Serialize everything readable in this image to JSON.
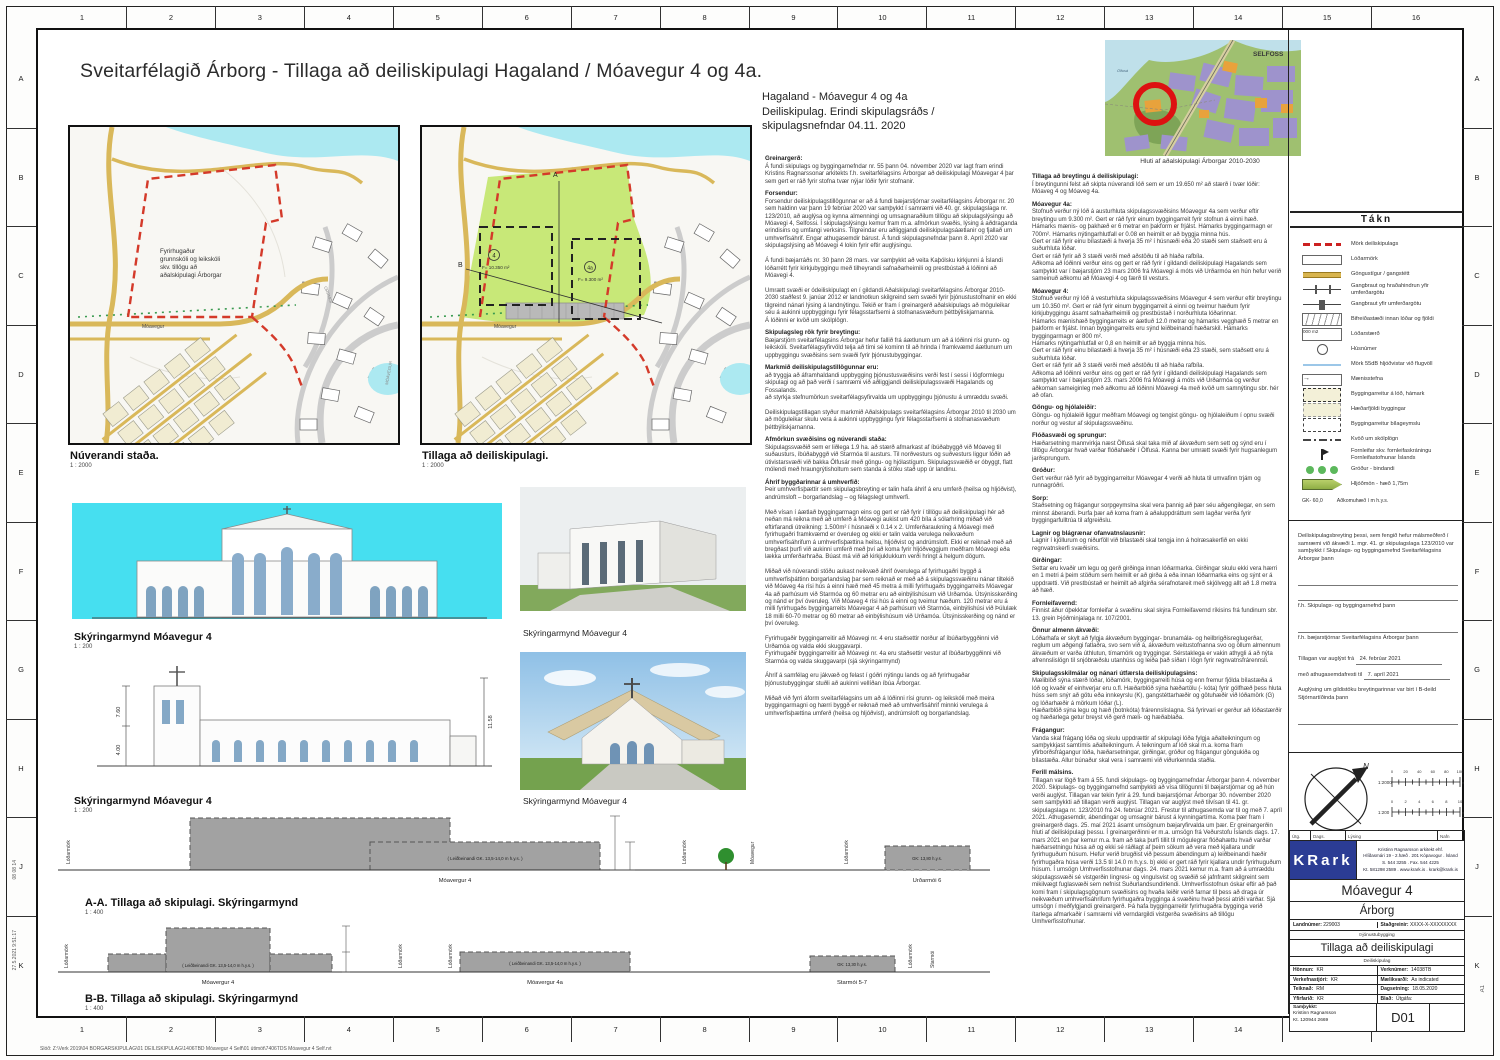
{
  "title": "Sveitarfélagið Árborg - Tillaga að deiliskipulagi Hagaland / Móavegur 4 og 4a.",
  "header_note": "Hagaland -  Móavegur 4 og 4a\nDeiliskipulag. Erindi skipulagsráðs /\nskipulagsnefndar 04.11. 2020",
  "frame": {
    "cols": [
      "1",
      "2",
      "3",
      "4",
      "5",
      "6",
      "7",
      "8",
      "9",
      "10",
      "11",
      "12",
      "13",
      "14",
      "15",
      "16"
    ],
    "rows": [
      "A",
      "B",
      "C",
      "D",
      "E",
      "F",
      "G",
      "H",
      "J",
      "K"
    ]
  },
  "maps": {
    "left": {
      "label": "Núverandi staða.",
      "scale": "1 : 2000",
      "school_lines": [
        "Fyrirhugaður",
        "grunnskóli og leikskóli",
        "skv. tillögu að",
        "aðalskipulagi Árborgar"
      ],
      "street": "Móavegur"
    },
    "right": {
      "label": "Tillaga að deiliskipulagi.",
      "scale": "1 : 2000",
      "p4": {
        "num": "4",
        "area": "F= 10.350 m²"
      },
      "p4a": {
        "num": "4a",
        "area": "F= 9.300 m²"
      },
      "markA": "A",
      "markB": "B",
      "street": "Móavegur"
    },
    "street_orrmoi": "ORRMÓI",
    "street_moavegur": "MÓAVEGUR"
  },
  "overview": {
    "caption": "Hluti af aðalskipulagi Árborgar 2010-2030",
    "city": "SELFOSS",
    "river": "Ölfusá"
  },
  "elev1": {
    "caption": "Skýringarmynd Móavegur 4",
    "scale": "1 : 200"
  },
  "elev2": {
    "caption": "Skýringarmynd Móavegur 4",
    "scale": "1 : 200",
    "dims": [
      "7.60",
      "4.00",
      "11.58"
    ]
  },
  "render1": {
    "caption": "Skýringarmynd Móavegur 4"
  },
  "render2": {
    "caption": "Skýringarmynd Móavegur 4"
  },
  "sec": {
    "lod": "Lóðarmörk",
    "gk_note": "( Leiðbeinandi GK. 13,5-14,0 m h.y.s. )",
    "a": {
      "title": "A-A. Tillaga að skipulagi. Skýringarmynd",
      "scale": "1 : 400",
      "b1": "Móavergur 4",
      "b2": "Urðarmói 6",
      "gk2": "GK: 13,80 h.y.s.",
      "street": "Móavegur"
    },
    "b": {
      "title": "B-B. Tillaga að skipulagi. Skýringarmynd",
      "scale": "1 : 400",
      "b1": "Móavergur 4",
      "b2": "Móavergur 4a",
      "b3": "Starmói 5-7",
      "gk3": "GK: 13,30 h.y.s.",
      "street": "Starmói"
    }
  },
  "col1": {
    "sections": [
      {
        "h": "Greinargerð:",
        "p": "Á fundi skipulags og byggingarnefndar nr. 55 þann 04. nóvember 2020 var lagt fram erindi Kristins Ragnarssonar arkitekts f.h. sveitarfélagsins Árborgar að deiliskipulagi Móavegar 4 þar sem gert er ráð fyrir stofna tvær nýjar lóðir fyrir stofnanir."
      },
      {
        "h": "Forsendur:",
        "p": "Forsendur deiliskipulagstillögunnar er að á fundi bæjarstjórnar sveitarfélagsins Árborgar nr. 20 sem haldinn var þann 19 febrúar 2020 var samþykkt í samræmi við 40. gr. skipulagslaga nr. 123/2010, að auglýsa og kynna almenningi og umsagnaraðilum tillögu að skipulagslýsingu að Móavegi 4, Selfossi. Í skipulagslýsingu kemur fram m.a. afmörkun svæðis, lýsing á aðdraganda erindisins og umfangi verksins. Tilgreindar eru aðliggjandi deiliskipulagsáætlanir og fjallað um umhverfisáhrif. Engar athugasemdir bárust. Á fundi skipulagsnefndar þann 8. Apríl 2020 var skipulagslýsing að Móavegi 4 lokin fyrir eftir auglýsingu.\n\nÁ fundi bæjarráðs nr. 30 þann 28 mars. var samþykkt að veita Kaþólsku kirkjunni á Íslandi lóðarrétt fyrir kirkjubyggingu með tilheyrandi safnaðarheimili og prestbústað á lóðinni að Móavegi 4.\n\nUmrætt svæði er ódeiliskipulagt en í gildandi Aðalskipulagi sveitarfélagsins Árborgar 2010-2030 staðfest 9. janúar 2012 er landnotkun skilgreind sem svæði fyrir þjónustustofnanir en ekki tilgreind nánari lýsing á landnýtingu. Tekið er fram í greinargerð aðalskipulags að möguleikar séu á aukinni uppbyggingu fyrir félagsstarfsemi á stofnanasvæðum þéttbýliskjarnanna.\nÁ lóðinni er kvöð um skólplögn."
      },
      {
        "h": "Skipulagsleg rök fyrir breytingu:",
        "p": "Bæjarstjórn sveitarfélagsins Árborgar hefur fallið frá áætlunum um að á lóðinni rísi grunn- og leikskóli. Sveitarfélagsyfirvöld telja að tími sé kominn til að hrinda í framkvæmd áætlunum um uppbyggingu svæðisins sem svæði fyrir þjónustubyggingar."
      },
      {
        "h": "Markmið deiliskipulagstillögunnar eru:",
        "p": "að tryggja að áframhaldandi uppbygging þjónustusvæðisins verði fest í sessi í lögformlegu skipulagi og að það verði í samræmi við aðliggjandi deiliskipulagssvæði Hagalands og Fossalands.\nað styrkja stefnumörkun sveitarfélagsyfirvalda um uppbyggingu þjónustu á umræddu svæði.\n\nDeiliskipulagstillagan styður markmið Aðalskipulags sveitarfélagsins Árborgar 2010 til 2030 um að möguleikar skulu vera á aukinni uppbyggingu fyrir félagsstarfsemi á stofnanasvæðum þéttbýliskjarnanna."
      },
      {
        "h": "Afmörkun svæðisins og núverandi staða:",
        "p": "Skipulagssvæðið sem er liðlega 1.9 ha. að stærð afmarkast af íbúðabyggð við Móaveg til suðausturs, íbúðabyggð við Starmóa til austurs. Til norðvesturs og suðvesturs liggur lóðin að útivistarsvæði við bakka Ölfusár með göngu- og hjólastígum. Skipulagssvæðið er óbyggt, flatt mólendi með hraungrýtisholtum sem standa á stöku stað upp úr landinu."
      },
      {
        "h": "Áhrif byggðarinnar á umhverfið:",
        "p": "Þeir umhverfisþættir sem skipulagsbreyting er talin hafa áhrif á eru umferð (heilsa og hljóðvist), andrúmsloft – borgarlandslag – og félagslegt umhverfi.\n\nMeð vísan í áætlað byggingarmagn eins og gert er ráð fyrir í tillögu að deiliskipulagi hér að neðan má reikna með að umferð á Móavegi aukist um 420 bíla á sólarhring miðað við eftirfarandi útreikning: 1.500m² í húsnæði x 0.14 x 2. Umferðaraukning á Móavegi með fyrirhugaðri framkvæmd er óveruleg og ekki er talin valda verulega neikvæðum umhverfisáhrifum á umhverfisþættina heilsu, hljóðvist og andrúmsloft. Ekki er reiknað með að bregðast þurfi við aukinni umferð með því að koma fyrir hljóðveggjum meðfram Móavegi eða lækka umferðarhraða. Búast má við að kirkjuklukkum verði hringt á helgum dögum.\n\nMiðað við núverandi stöðu aukast neikvæð áhrif óverulega af fyrirhugaðri byggð á umhverfisþáttinn borgarlandslag þar sem reiknað er með að á skipulagssvæðinu nánar tiltekið við Móaveg 4a rísi hús á einni hæð með 45 metra á milli fyrirhugaðs byggingarreits Móavegar 4a að parhúsum við Starmóa og 60 metrar eru að einbýlishúsum við Urðamóa. Útsýnisskerðing og nánd er því óveruleg. Við Móaveg 4 rísi hús á einni og tveimur hæðum. 120 metrar eru á milli fyrirhugaðs byggingarreits Móavegar 4 að parhúsum við Starmóa, einbýlishúsi við Þúlulæk 18 milli 60-70 metrar og 60 metrar að einbýlishúsum við Urðamóa. Útsýnisskerðing og nánd er því óveruleg.\n\nFyrirhugaðir byggingarreitir að Móavegi nr. 4 eru staðsettir norður af íbúðarbyggðinni við Urðamóa og valda ekki skuggavarpi.\nFyrirhugaðir byggingarreitir að Móavegi nr. 4a eru staðsettir vestur af íbúðarbyggðinni við Starmóa og valda skuggavarpi (sjá skýringarmynd)\n\nÁhrif á samfélag eru jákvæð og felast í góðri nýtingu lands og að fyrirhugaðar þjónustubyggingar stuðli að aukinni vellíðan íbúa Árborgar.\n\nMiðað við fyrri áform sveitarfélagsins um að á lóðinni rísi grunn- og leikskóli með meira byggingarmagni og hærri byggð er reiknað með að umhverfisáhrif minnki verulega á umhverfisþættina umferð (heilsa og hljóðvist), andrúmsloft og borgarlandslag."
      }
    ]
  },
  "col2": {
    "sections": [
      {
        "h": "Tillaga að breytingu á deiliskipulagi:",
        "p": "Í breytingunni felst að skipta núverandi lóð sem er um 19.650 m² að stærð í tvær lóðir: Móaveg 4 og Móaveg 4a."
      },
      {
        "h": "Móavegur 4a:",
        "p": "Stofnuð verður ný lóð á austurhluta skipulagssvæðisins Móavegur 4a sem verður eftir breytingu um 9.300 m². Gert er ráð fyrir einum byggingarreit fyrir stofnun á einni hæð. Hámarks mænis- og þakhæð er 6 metrar en þakform er frjálst. Hámarks byggingarmagn er 700m². Hámarks nýtingarhlutfall er 0.08 en heimilt er að byggja minna hús.\nGert er ráð fyrir einu bílastæði á hverja 35 m² í húsnæði eða 20 stæði sem staðsett eru á suðurhluta lóðar.\nGert er ráð fyrir að 3 stæði verði með aðstöðu til að hlaða rafbíla.\nAðkoma að lóðinni verður eins og gert er ráð fyrir í gildandi deiliskipulagi Hagalands sem samþykkt var í bæjarstjórn 23 mars 2006 frá Móavegi á móts við Urðarmóa en hún hefur verið sameinuð aðkomu að Móavegi 4 og færð til vesturs."
      },
      {
        "h": "Móavegur 4:",
        "p": "Stofnuð verður ný lóð á vesturhluta skipulagssvæðisins Móavegur 4 sem verður eftir breytingu um 10.350 m². Gert er ráð fyrir einum byggingarreit á einni og tveimur hæðum fyrir kirkjubyggingu ásamt safnaðarheimili og prestbústað í norðurhluta lóðarinnar.\nHámarks mænishæð byggingarreits er áætluð 12.0 metrar og hámarks vegghæð 5 metrar en þakform er frjálst. Innan byggingarreits eru sýnd leiðbeinandi hæðarskil.  Hámarks byggingarmagn er 800 m².\nHámarks nýtingarhlutfall er  0,8 en heimilt er að byggja minna hús.\nGert er ráð fyrir einu bílastæði á hverja 35 m² í húsnæði eða 23 stæði, sem staðsett eru á suðurhluta lóðar.\nGert er ráð fyrir að 3 stæði verði með aðstöðu til að hlaða rafbíla.\nAðkoma að lóðinni verður eins og gert er ráð fyrir í gildandi deiliskipulagi Hagalands sem samþykkt var í bæjarstjórn 23. mars 2006 frá Móavegi á móts við Urðarmóa og verður aðkoman sameiginleg með aðkomu að lóðinni  Móavegi 4a með kvöð  um samnýtingu sbr. hér að ofan."
      },
      {
        "h": "Göngu- og hjólaleiðir:",
        "p": "Göngu- og hjólaleið liggur meðfram Móavegi og tengist göngu- og hjólaleiðum í opnu svæði norður og vestur af skipulagssvæðinu."
      },
      {
        "h": "Flóðasvæði og sprungur:",
        "p": "Hæðarsetning mannvirkja næst Ölfusá skal taka mið af ákvæðum sem sett og sýnd eru í tillögu Árborgar hvað varðar flóðahæðir í Ölfusá. Kanna ber umrætt svæði fyrir hugsanlegum jarðsprungum."
      },
      {
        "h": "Gróður:",
        "p": "Gert verður ráð fyrir að byggingarreitur Móavegar 4 verði að hluta til umvafinn trjám og runnagróðri."
      },
      {
        "h": "Sorp:",
        "p": "Staðsetning og frágangur sorpgeymslna skal vera þannig að þær séu aðgengilegar, en sem minnst áberandi. Þurfa þær að koma fram á aðaluppdráttum sem lagðar verða fyrir byggingarfulltrúa til afgreiðslu."
      },
      {
        "h": "Lagnir og blágrænar ofanvatnslausnir:",
        "p": "Lagnir í kjöllurum og niðurföll við bílastæði skal tengja inn á holræsakerfið en ekki regnvatnskerfi svæðisins."
      },
      {
        "h": "Girðingar:",
        "p": "Settar eru kvaðir um legu og gerð girðinga  innan lóðarmarka. Girðingar skulu ekki vera hærri en 1 metri á þeim stöðum sem heimilt er að girða á eða innan lóðarmarka eins og sýnt er á uppdrætti. Við prestbústað er heimilt að afgirða sérafnotareit með skjólvegg allt að 1.8 metra að hæð."
      },
      {
        "h": "Fornleifavernd:",
        "p": "Finnist áður óþekktar fornleifar á svæðinu skal skýra Fornleifavernd ríkisins frá fundinum sbr. 13. grein Þjóðminjalaga nr. 107/2001."
      },
      {
        "h": "Önnur almenn ákvæði:",
        "p": "Lóðarhafa er skylt að fylgja ákvæðum byggingar- brunamála- og heilbrigðisreglugerðar, reglum um aðgengi fatlaðra, svo sem við á, ákvæðum veitustofnanna svo og öllum almennum ákvæðum er varða úthlutun, tímamörk og tryggingar. Sérstaklega er vakin athygli á að nýta afrennslislögn til snjóbræðslu utanhúss og leiða það síðan í lögn fyrir regnvatnsfrárennsli."
      },
      {
        "h": "Skipulagsskilmálar og nánari útfærsla deiliskipulagsins:",
        "p": "Mæliblöð sýna stærð lóðar, lóðamörk, byggingarreiti húsa og enn fremur fjölda bílastæða á lóð og kvaðir ef einhverjar eru o.fl. Hæðarblöð sýna hæðartölu (- kóta) fyrir gólfhæð þess hluta húss sem snýr að götu eða innkeyrslu (K), gangstéttarhæðir og götuhæðir við lóðamörk (G) og lóðarhæðir á mörkum lóðar (L).\nHæðarblöð sýna legu og hæð (botnkóta) frárennslislagna. Sá fyrirvari er gerður að lóðastærðir og hæðarlega getur breyst við gerð mæli- og hæðablaða."
      },
      {
        "h": "Frágangur:",
        "p": "Vanda skal frágang lóða og skulu uppdrættir af skipulagi lóða fylgja aðalteikningum og samþykkjast samtímis aðalteikningum. Á teikningum af lóð skal m.a. koma fram yfirborðsfrágangur lóða, hæðarsetningar, girðingar, gróður og frágangur göngukiða og bílastæða. Allur búnaður skal vera í samræmi við viðurkennda staðla."
      },
      {
        "h": "Ferill málsins.",
        "p": "Tillagan var lögð fram á 55. fundi skipulags- og byggingarnefndar Árborgar þann 4. nóvember 2020. Skipulags- og byggingarnefnd samþykkti að vísa tillögunni til bæjarstjórnar og að hún verði auglýst. Tillagan var tekin fyrir á 29. fundi bæjarstjórnar Árborgar 30. nóvember 2020 sem samþykkti að tillagan verði auglýst. Tillagan var auglýst með tilvísan til 41. gr. skipulagslaga nr. 123/2010 frá 24. febrúar 2021. Frestur til athugasemda var til og með 7. apríl 2021. Athugasemdir, ábendingar og umsagnir bárust á kynningartíma. Koma þær fram í greinargerð dags. 25. maí 2021 ásamt umsögnum bæjaryfirvalda um þær. Er greinargerðin hluti af deiliskipulagi þessu. Í greinargerðinni er m.a. umsögn frá Veðurstofu Íslands dags. 17. mars 2021 en þar kemur m.a. fram að taka þurfi tillit til mögulegrar flóðahættu hvað varðar hæðarsetningu húsa að og ekki sé ráðlagt af þeim sökum að vera með kjallara undir fyrirhuguðum húsum. Hefur verið brugðist við þessum ábendingum a) leiðbeinandi hæðir fyrirhugaðra húsa verði 13.5 til 14.0 m h.y.s. b) ekki er gert ráð fyrir kjallara undir fyrirhuguðum húsum. Í umsögn Umhverfisstofnunar dags. 24. mars 2021 kemur m.a. fram að á umræddu skipulagssvæði sé vistgerðin lingresi- og vingulsvist og svæðið sé jafnframt skilgreint sem mikilvægt fuglasvæði sem nefnist Suðurlandsundirlendi. Umhverfisstofnun óskar eftir að það komi fram í skipulagsgögnum svæðisins og hvaða leiðir verið farnar til þess að draga úr neikvæðum umhverfisáhrifum fyrirhugaðra bygginga á svæðinu hvað þessi atriði varðar. Sjá umsögn í meðfylgjandi greinargerð. Þá hafa byggingarreitir fyrirhugaðra bygginga verið ítarlega afmarkaðir í samræmi við verndargildi vistgerða svæðisins að tillögu Umhverfisstofnunar."
      }
    ]
  },
  "legend": {
    "title": "Tákn",
    "items": [
      {
        "c": "boundary",
        "sym": "",
        "label": "Mörk deiliskipulags"
      },
      {
        "c": "lotline",
        "sym": "",
        "label": "Lóðarmörk"
      },
      {
        "c": "path",
        "sym": "",
        "label": "Göngustígur / gangstétt"
      },
      {
        "c": "xbump",
        "sym": "",
        "label": "Gangbraut og hraðahindrun yfir umferðargötu"
      },
      {
        "c": "xwalk",
        "sym": "",
        "label": "Gangbraut yfir umferðargötu"
      },
      {
        "c": "parking",
        "sym": "",
        "label": "Bifreiðastæði innan lóðar og fjöldi"
      },
      {
        "c": "lotsize",
        "sym": "000 m2",
        "label": "Lóðarstærð"
      },
      {
        "c": "housenum",
        "sym": "",
        "label": "Húsnúmer"
      },
      {
        "c": "noise55",
        "sym": "",
        "label": "Mörk 55dB hljóðvistar við flugvöll"
      },
      {
        "c": "ridge",
        "sym": "→",
        "label": "Mænisstefna"
      },
      {
        "c": "bldgreit",
        "sym": "",
        "label": "Byggingarreitur á lóð, hámark"
      },
      {
        "c": "heightzone",
        "sym": "",
        "label": "Hæðarfjöldi byggingar"
      },
      {
        "c": "garagereit",
        "sym": "",
        "label": "Byggingarreitur bílageymslu"
      },
      {
        "c": "sewer",
        "sym": "",
        "label": "Kvöð um skólplögn"
      },
      {
        "c": "fornleifar",
        "sym": "",
        "label": "Fornleifar skv. fornleifaskráningu Fornleifastofnunar Íslands"
      },
      {
        "c": "grodur",
        "sym": "",
        "label": "Gróður - bindandi"
      },
      {
        "c": "hljodmon",
        "sym": "",
        "label": "Hljóðmön - hæð 1,75m"
      }
    ],
    "gk_sym": "GK- 60,0",
    "gk_label": "Aðkomuhæð í m h.y.s."
  },
  "approval": {
    "intro": "Deiliskipulagsbreyting þessi, sem fengið hefur málsmeðferð í samræmi við ákvæði 1. mgr. 41. gr skipulagslaga 123/2010 var samþykkt í Skipulags- og byggingarnefnd Sveitarfélagsins Árborgar þann",
    "line1": "f.h. Skipulags- og byggingarnefnd þann",
    "line2": "f.h. bæjarstjórnar Sveitarfélagsins Árborgar þann",
    "ad1_label": "Tillagan var auglýst frá",
    "ad1_value": "24. febrúar 2021",
    "ad2_label": "með athugasemdafresti til",
    "ad2_value": "7. apríl 2021",
    "gildistaka": "Auglýsing um gildistöku breytingarinnar var birt í B-deild Stjórnartíðinda þann"
  },
  "scale": {
    "north": "N",
    "s2000": {
      "name": "1:2000",
      "ticks": [
        "0",
        "20",
        "40",
        "60",
        "80",
        "100"
      ],
      "unit": "m"
    },
    "s200": {
      "name": "1:200",
      "ticks": [
        "0",
        "2",
        "4",
        "6",
        "8",
        "10"
      ],
      "unit": "m"
    }
  },
  "titleblock": {
    "rev": {
      "utg": "Útg.",
      "dags": "Dags.",
      "lysing": "Lýsing",
      "nafn": "Nafn"
    },
    "logo": "KRark",
    "firm_lines": [
      "Kristinn Ragnarsson arkitekt ehf.",
      "Hlíðasmári 19 - 2.hæð . 201 Kópavogur . Ísland",
      "S. 544 3255 . Fax. 544 4225",
      "Kt. 581298 2589 . www.krark.is . krark@krark.is"
    ],
    "project": "Móavegur 4",
    "city": "Árborg",
    "land_label": "Landnúmer:",
    "land_value": "229003",
    "stad_label": "Staðgreinir:",
    "stad_value": "XXXX-X-XXXXXXXX",
    "use": "Þjónustubygging",
    "doc_title": "Tillaga að deiliskipulagi",
    "doc_sub": "Deiliskipulag",
    "meta": [
      {
        "l": "Hönnun:",
        "lv": "KR",
        "r": "Verknúmer:",
        "rv": "14038TB"
      },
      {
        "l": "Verkefnastjóri:",
        "lv": "KR",
        "r": "Mælikvarði:",
        "rv": "As indicated"
      },
      {
        "l": "Teiknað:",
        "lv": "RM",
        "r": "Dagsetning:",
        "rv": "18.05.2020"
      },
      {
        "l": "Yfirfarið:",
        "lv": "KR",
        "r": "Blað:",
        "rv": "Útgáfa:"
      }
    ],
    "appr_label": "Samþykkt:",
    "appr_name": "Kristinn Ragnarsson",
    "appr_kt": "Kt. 120944 2669",
    "sheet": "D01"
  },
  "edge": {
    "plot_stamp": "08 08 14",
    "plot_time": "27.5.2021 9:51:17",
    "sheet_size": "A1",
    "file_path": "Slóð:   Z:\\Verk 2019\\04 BORGARSKIPULAG\\01 DEILISKIPULAG\\1406TBD Móavegur 4 Self\\01 útimöt\\7406TDS Móavegur 4 Self.rvt"
  }
}
